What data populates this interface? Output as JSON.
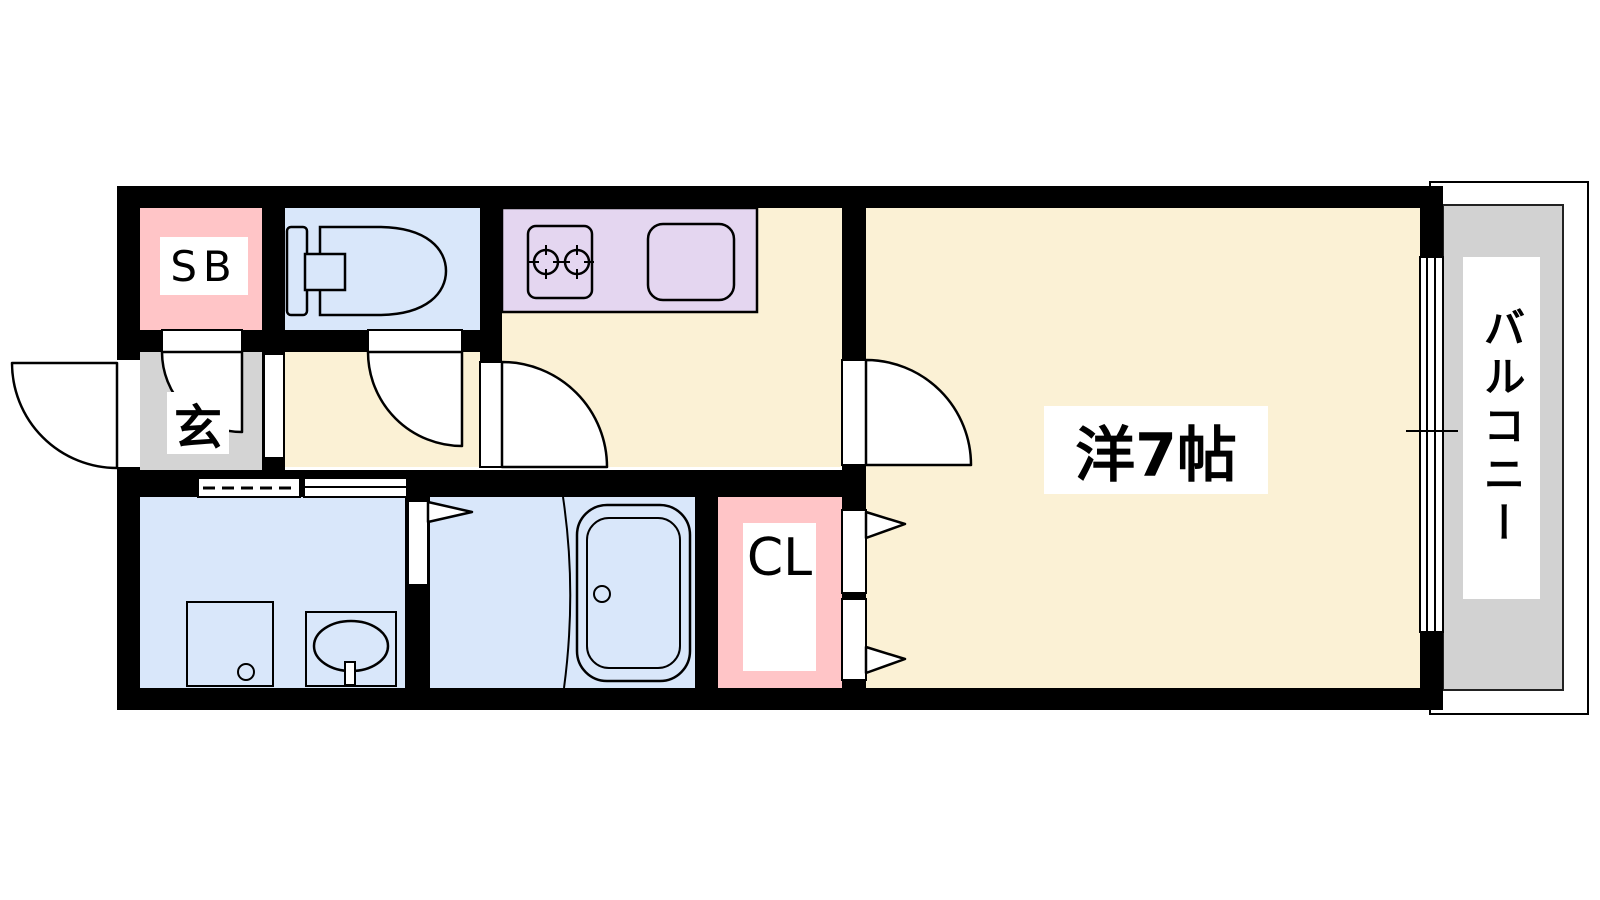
{
  "plan_title": "1K apartment floor plan",
  "labels": {
    "shoe_box": "SB",
    "entrance": "玄",
    "main_room": "洋7帖",
    "closet": "CL",
    "balcony": "バルコニー"
  },
  "colors": {
    "wall": "#000000",
    "room_floor": "#FBF1D5",
    "wet_area": "#D9E7FA",
    "kitchen_counter": "#E4D6F0",
    "storage": "#FFC5C7",
    "entrance_floor": "#D4D4D4",
    "balcony_floor": "#D2D2D2",
    "background": "#FFFFFF"
  },
  "rooms": [
    {
      "name": "shoe-box",
      "label": "SB"
    },
    {
      "name": "toilet",
      "label": ""
    },
    {
      "name": "kitchen",
      "label": ""
    },
    {
      "name": "entrance-genkan",
      "label": "玄"
    },
    {
      "name": "western-room-7jo",
      "label": "洋7帖"
    },
    {
      "name": "washroom",
      "label": ""
    },
    {
      "name": "bathroom",
      "label": ""
    },
    {
      "name": "closet",
      "label": "CL"
    },
    {
      "name": "balcony",
      "label": "バルコニー"
    }
  ]
}
